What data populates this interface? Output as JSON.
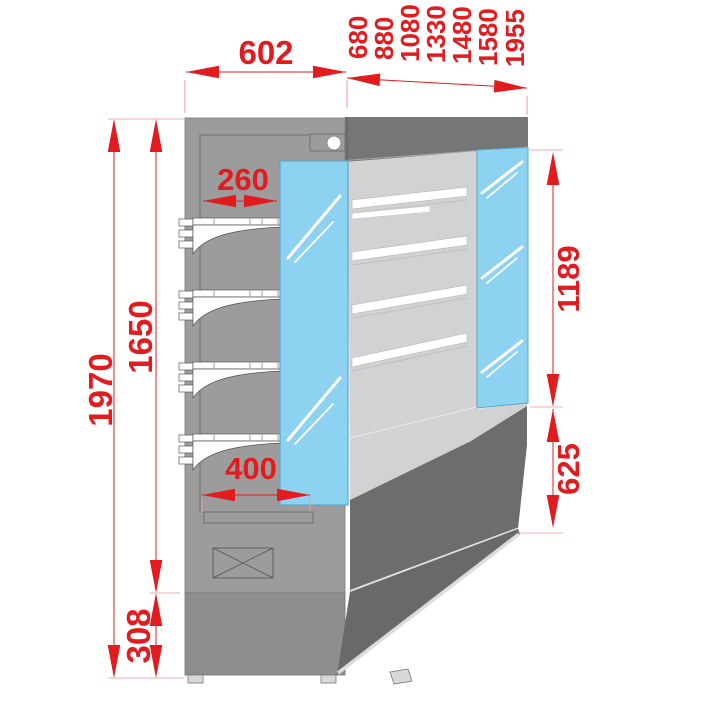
{
  "drawing": {
    "description": "Side elevation technical drawing of an open-front refrigerated multideck display case with dimensions in millimetres",
    "colors": {
      "dimension_red": "#e11b1e",
      "glass_blue": "#8ed2f2",
      "panel_gray": "#9c9c9c",
      "canopy_gray": "#767676",
      "interior_gray": "#d2d2d2",
      "base_dark_gray": "#6d6d6d",
      "plinth_flat_gray": "#8e8e8e"
    },
    "dimensions": {
      "depth_top": "602",
      "length_options": [
        "680",
        "880",
        "1080",
        "1330",
        "1480",
        "1580",
        "1955"
      ],
      "height_total": "1970",
      "height_body": "1650",
      "height_plinth": "308",
      "depth_top_shelf": "260",
      "depth_bottom_shelf": "400",
      "height_opening": "1189",
      "height_base_front": "625"
    }
  }
}
